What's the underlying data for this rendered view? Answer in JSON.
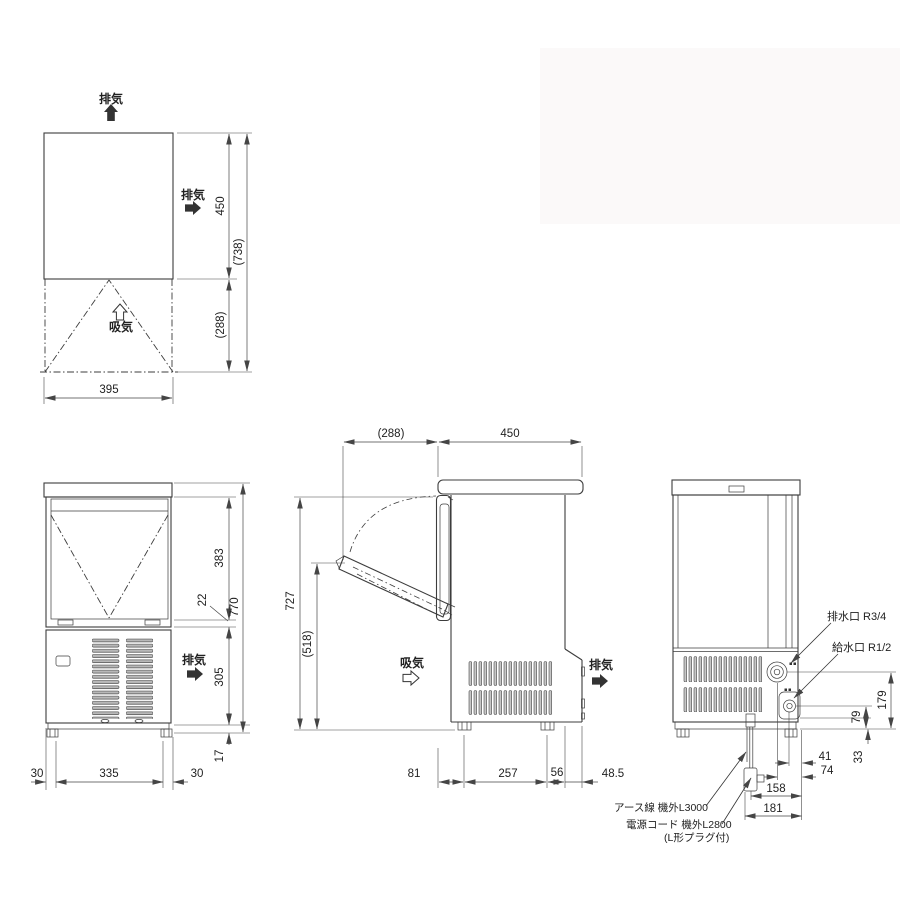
{
  "colors": {
    "line": "#3c3c3c",
    "photo_background": "#fbf9f9"
  },
  "views": {
    "top": {
      "exhaust_top": "排気",
      "exhaust_right": "排気",
      "intake": "吸気",
      "d450": "450",
      "d738": "(738)",
      "d288": "(288)",
      "d395": "395"
    },
    "front": {
      "exhaust": "排気",
      "d383": "383",
      "d22": "22",
      "d770": "770",
      "d305": "305",
      "d17": "17",
      "d30l": "30",
      "d335": "335",
      "d30r": "30"
    },
    "side": {
      "intake": "吸気",
      "exhaust": "排気",
      "d288": "(288)",
      "d450": "450",
      "d727": "727",
      "d518": "(518)",
      "d81": "81",
      "d257": "257",
      "d56": "56",
      "d48_5": "48.5"
    },
    "rear": {
      "drain_label": "排水口  R3/4",
      "water_label": "給水口  R1/2",
      "d179": "179",
      "d79": "79",
      "d33": "33",
      "d41": "41",
      "d74": "74",
      "d158": "158",
      "d181": "181",
      "earth_label": "アース線 機外L3000",
      "power_label": "電源コード 機外L2800",
      "plug_note": "(L形プラグ付)"
    }
  }
}
